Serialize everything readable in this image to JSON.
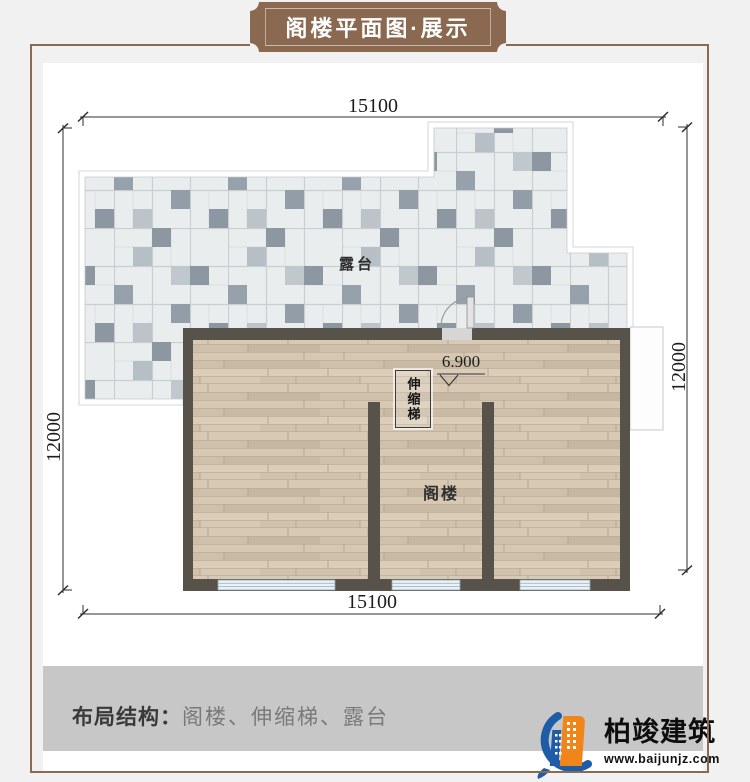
{
  "header": {
    "title": "阁楼平面图·展示"
  },
  "dimensions": {
    "top": "15100",
    "bottom": "15100",
    "left": "12000",
    "right": "12000"
  },
  "plan": {
    "terrace_label": "露台",
    "attic_label": "阁楼",
    "ladder_label": "伸缩梯",
    "elevation_value": "6.900"
  },
  "footer": {
    "layout_label": "布局结构：",
    "layout_items": "阁楼、伸缩梯、露台"
  },
  "brand": {
    "name": "柏竣建筑",
    "website": "www.baijunjz.com"
  },
  "colors": {
    "frame_brown": "#8a6a52",
    "banner_brown": "#8a6950",
    "wall": "#57524a",
    "tile_dark": "#8d97a2",
    "wood_base": "#d5c5b1",
    "window_blue": "#eaf2f7",
    "footer_bar": "#c7c7c7",
    "logo_blue": "#1e5ca8",
    "logo_orange": "#f08519"
  }
}
